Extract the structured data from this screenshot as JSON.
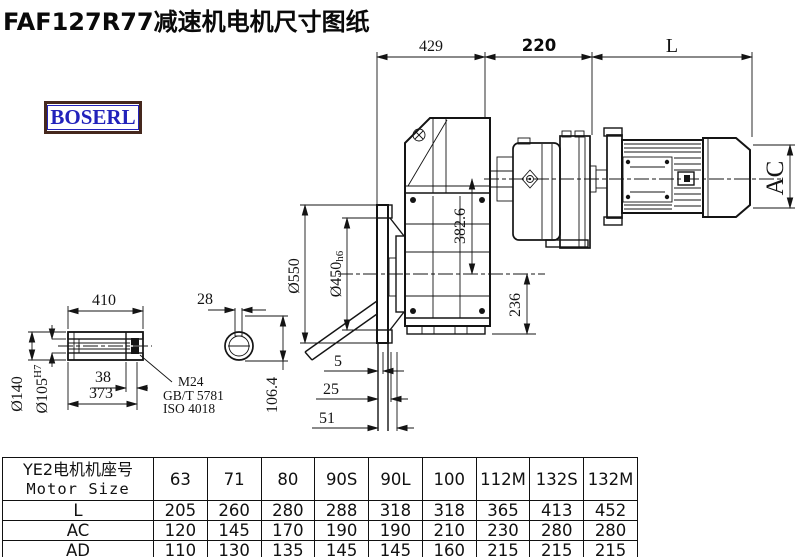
{
  "title": "FAF127R77减速机电机尺寸图纸",
  "logo": {
    "text": "BOSERL"
  },
  "drawing": {
    "dims": {
      "top_width_1": "429",
      "top_width_2": "220",
      "motor_length": "L",
      "motor_diameter": "AC",
      "flange_od": "Ø550",
      "spigot_d": "Ø450",
      "spigot_tol": "h6",
      "axis_height": "382.6",
      "base_height": "236",
      "offset_1": "5",
      "offset_2": "25",
      "offset_3": "51",
      "shaft_length": "410",
      "keyway_width": "28",
      "shaft_od": "Ø140",
      "bore_d": "Ø105",
      "bore_tol": "H7",
      "key_len": "38",
      "bore_len": "373",
      "keyway_height": "106.4",
      "thread_note_1": "M24",
      "thread_note_2": "GB/T 5781",
      "thread_note_3": "ISO 4018"
    }
  },
  "table": {
    "header_cn": "YE2电机机座号",
    "header_en": "Motor Size",
    "columns": [
      "63",
      "71",
      "80",
      "90S",
      "90L",
      "100",
      "112M",
      "132S",
      "132M"
    ],
    "rows": [
      {
        "label": "L",
        "values": [
          "205",
          "260",
          "280",
          "288",
          "318",
          "318",
          "365",
          "413",
          "452"
        ]
      },
      {
        "label": "AC",
        "values": [
          "120",
          "145",
          "170",
          "190",
          "190",
          "210",
          "230",
          "280",
          "280"
        ]
      },
      {
        "label": "AD",
        "values": [
          "110",
          "130",
          "135",
          "145",
          "145",
          "160",
          "215",
          "215",
          "215"
        ]
      }
    ]
  }
}
